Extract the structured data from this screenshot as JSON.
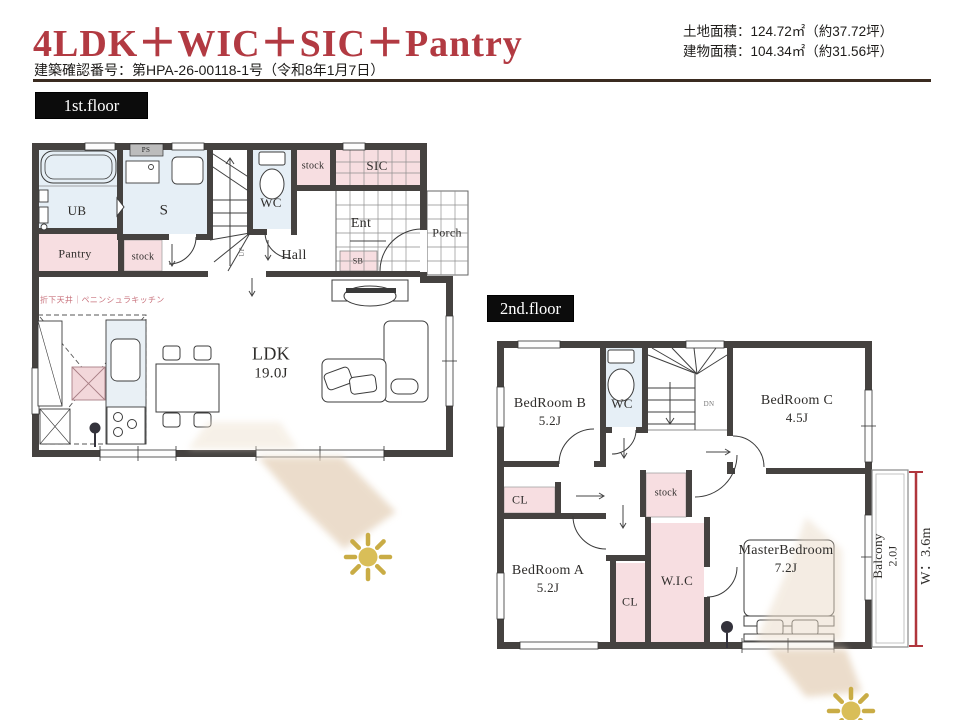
{
  "header": {
    "title": "4LDK＋WIC＋SIC＋Pantry",
    "permit": "建築確認番号：第HPA-26-00118-1号（令和8年1月7日）",
    "land_area": "土地面積：124.72㎡（約37.72坪）",
    "building_area": "建物面積：104.34㎡（約31.56坪）"
  },
  "floor1": {
    "label": "1st.floor",
    "rooms": {
      "ub": "UB",
      "ps": "PS",
      "washroom": "S",
      "wc": "WC",
      "stock_top": "stock",
      "sic": "SIC",
      "entrance": "Ent",
      "porch": "Porch",
      "shoe_box": "SB",
      "pantry": "Pantry",
      "stock_mid": "stock",
      "hall": "Hall",
      "ldk_name": "LDK",
      "ldk_size": "19.0J",
      "up": "UP",
      "kitchen_note": "折下天井｜ペニンシュラキッチン"
    }
  },
  "floor2": {
    "label": "2nd.floor",
    "rooms": {
      "bedroom_b_name": "BedRoom B",
      "bedroom_b_size": "5.2J",
      "wc": "WC",
      "dn": "DN",
      "bedroom_c_name": "BedRoom C",
      "bedroom_c_size": "4.5J",
      "closet_b": "CL",
      "stock": "stock",
      "bedroom_a_name": "BedRoom A",
      "bedroom_a_size": "5.2J",
      "closet_a": "CL",
      "wic": "W.I.C",
      "master_name": "MasterBedroom",
      "master_size": "7.2J",
      "balcony_name": "Balcony",
      "balcony_size": "2.0J",
      "balcony_width": "W：3.6m"
    }
  },
  "colors": {
    "accent_red": "#b23a42",
    "wall": "#454240",
    "closet_pink": "#f7dee1",
    "water_blue": "#e6eff6",
    "sun_gold": "#d9be58",
    "beam_beige": "#e8d7c2",
    "divider_brown": "#3a2b20"
  }
}
